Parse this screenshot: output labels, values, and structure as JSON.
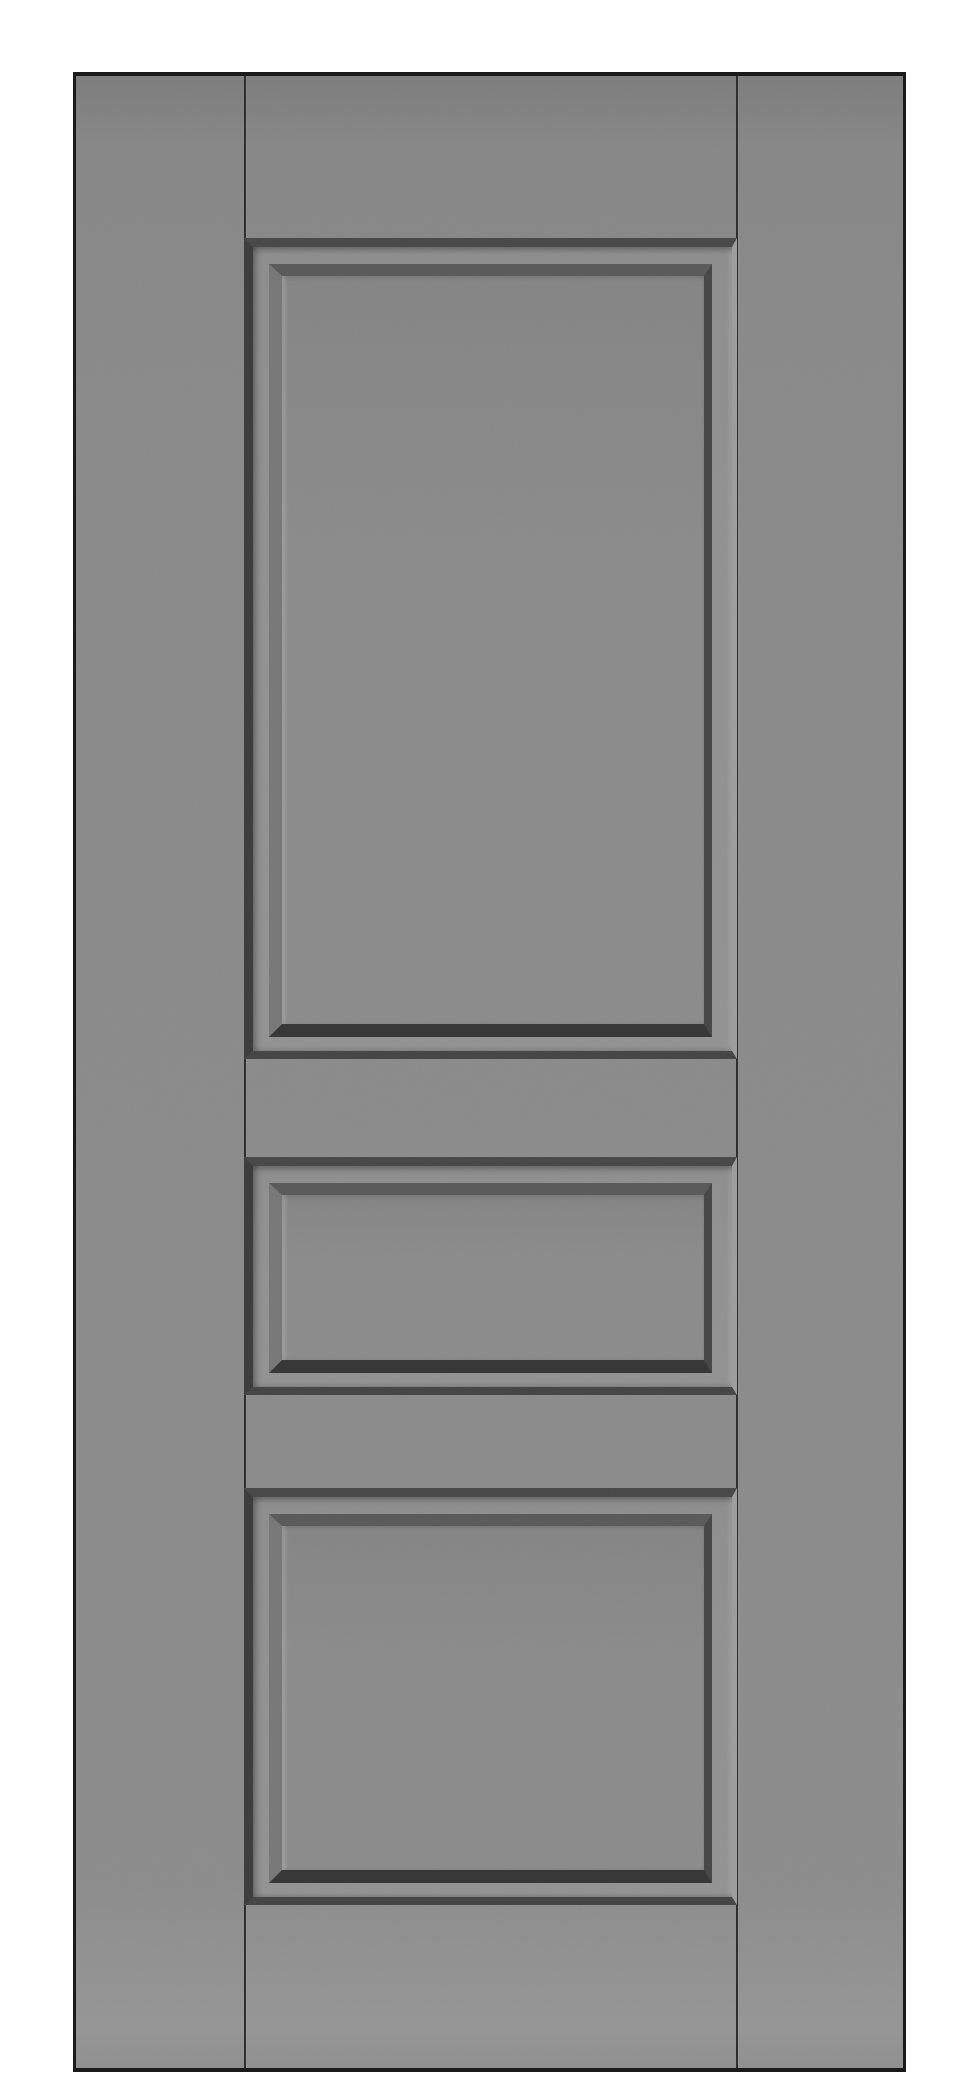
{
  "scene": {
    "description": "Studio product photograph of a plain gray painted three-panel interior door shown front-on, full height, centered on a white background",
    "object": "three-panel interior door",
    "background": "white",
    "finish": "matte gray paint",
    "hardware": "none (no handle, no hinges visible)",
    "panel_count": 3,
    "panels": [
      {
        "position": "top",
        "size": "large tall rectangular recessed panel with raised bevelled center"
      },
      {
        "position": "middle",
        "size": "small short rectangular recessed panel with raised bevelled center"
      },
      {
        "position": "bottom",
        "size": "large rectangular recessed panel with raised bevelled center"
      }
    ],
    "construction": "stile and rail door: two vertical stiles with visible joint seams, top rail, two mid rails, bottom rail"
  },
  "colors": {
    "bg": "#ffffff",
    "door-edge": "#1a1a1a",
    "door-face": "#8a8a8a",
    "door-face-top": "#7d7d7d",
    "door-face-bottom": "#969696",
    "seam": "#2d2d2d",
    "recess-top": "#484848",
    "recess-left": "#3c3c3c",
    "recess-right": "#9d9d9d",
    "recess-bottom": "#454545",
    "border-face": "#919191",
    "chamfer-top": "#5a5a5a",
    "chamfer-right": "#474747",
    "chamfer-bottom": "#363636",
    "chamfer-left": "#787878",
    "panel-face": "#8b8b8b",
    "panel-face-top": "#858585"
  }
}
